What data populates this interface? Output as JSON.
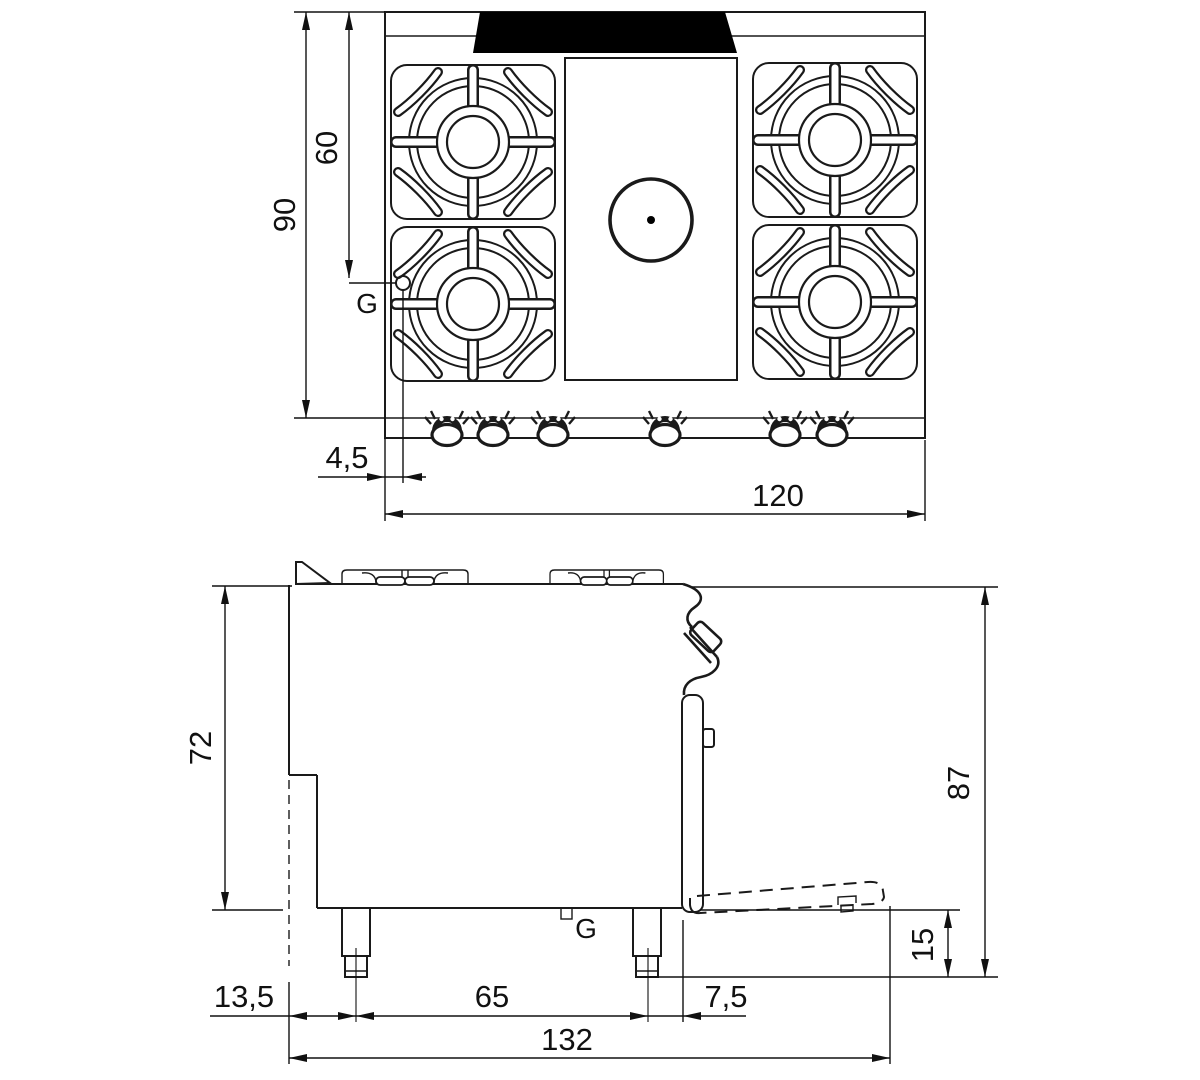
{
  "drawing": {
    "type": "technical-dimension-drawing",
    "subject": "gas range with 4 burners, central hot plate and oven",
    "unit_style": "centimeters (comma decimal)"
  },
  "top_view": {
    "width": "120",
    "depth": "90",
    "burner_row_offset": "60",
    "gas_offset": "4,5",
    "gas_label": "G",
    "burner_count": 4,
    "knob_count": 6
  },
  "side_view": {
    "body_height": "72",
    "total_height": "87",
    "plinth_height": "15",
    "back_to_first_leg": "13,5",
    "leg_spacing": "65",
    "leg_to_front": "7,5",
    "depth_door_open": "132",
    "gas_label": "G"
  },
  "colors": {
    "background": "#ffffff",
    "line": "#1a1a1a",
    "dimension": "#111111",
    "splash_guard_fill": "#000000"
  }
}
